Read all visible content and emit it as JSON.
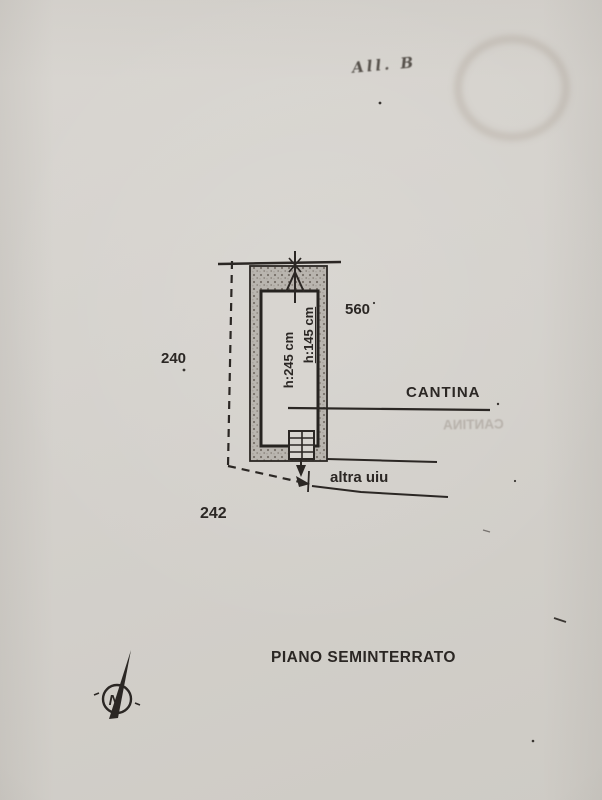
{
  "photo": {
    "handwritten_attachment_note": "All. B"
  },
  "plan": {
    "parcels": {
      "left": "240",
      "bottom": "242",
      "right": "560"
    },
    "room": {
      "label": "CANTINA",
      "height_main": "h:245 cm",
      "height_secondary": "h:145 cm"
    },
    "adjacent_unit_label": "altra uiu",
    "floor_title": "PIANO SEMINTERRATO",
    "north_letter": "N",
    "bleed_through_label": "CANTINA"
  },
  "colors": {
    "paper": "#d5d2cd",
    "ink": "#2b2724",
    "wall_fill": "#b7b3ad",
    "ghost_ink": "#a29a92"
  }
}
